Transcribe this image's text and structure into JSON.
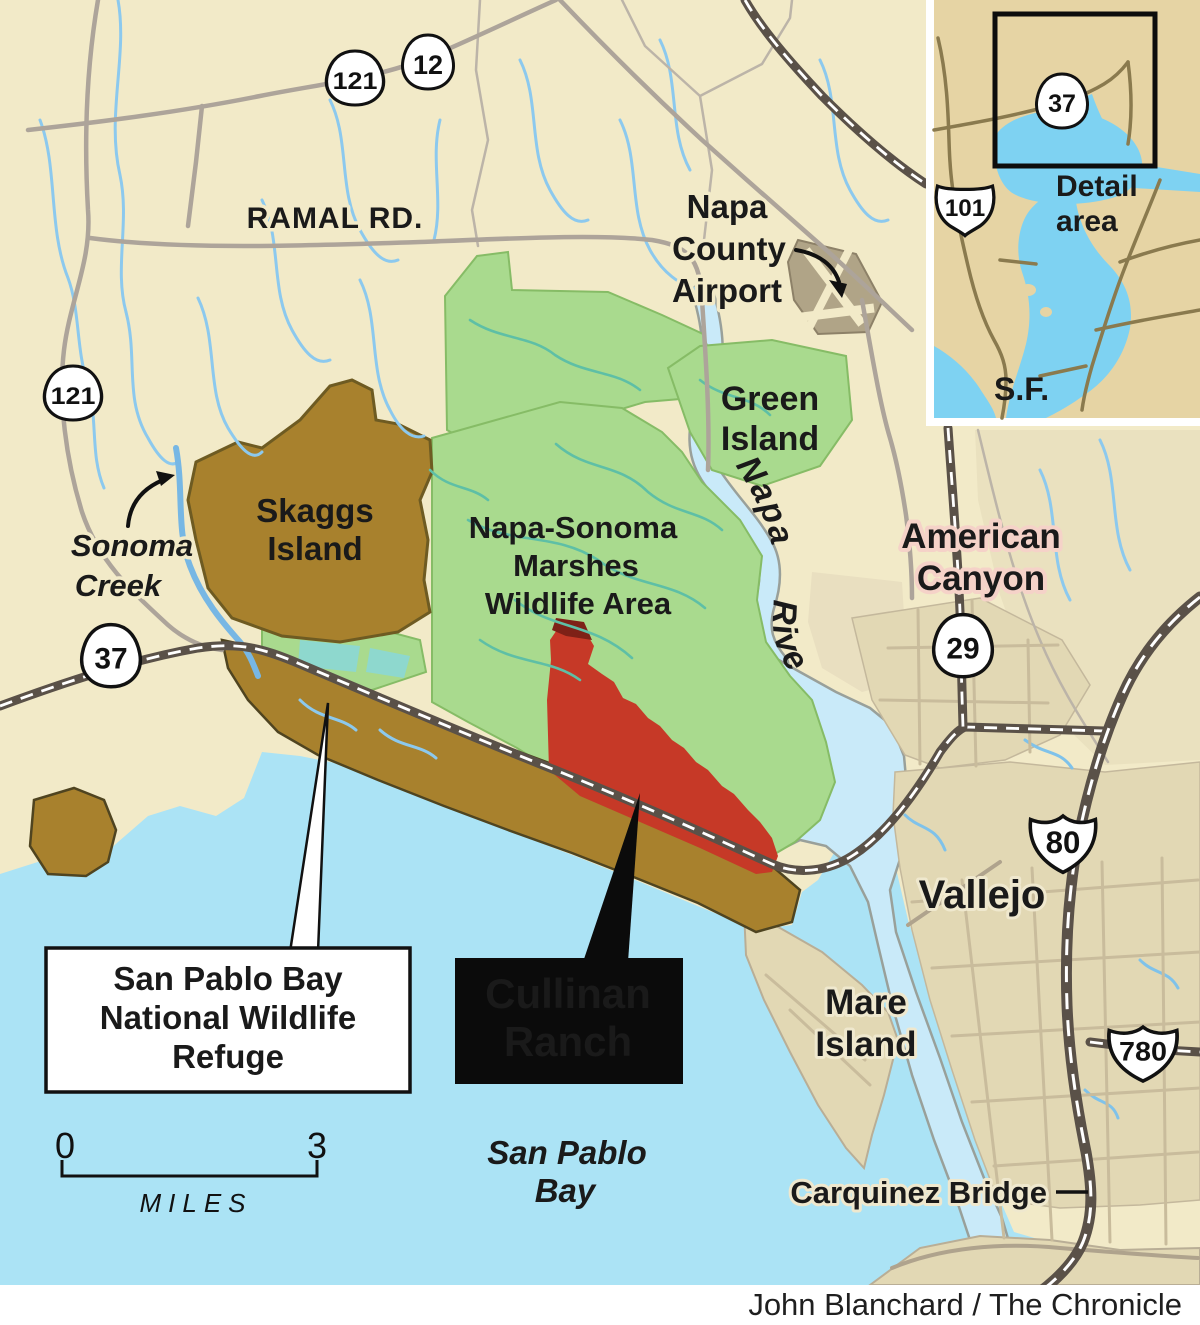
{
  "credit": "John Blanchard / The Chronicle",
  "labels": {
    "ramal_rd": "RAMAL RD.",
    "airport": [
      "Napa",
      "County",
      "Airport"
    ],
    "green_island": [
      "Green",
      "Island"
    ],
    "napa_river": "Napa River",
    "american_canyon": [
      "American",
      "Canyon"
    ],
    "sonoma_creek": [
      "Sonoma",
      "Creek"
    ],
    "skaggs_island": [
      "Skaggs",
      "Island"
    ],
    "marshes": [
      "Napa-Sonoma",
      "Marshes",
      "Wildlife Area"
    ],
    "vallejo": "Vallejo",
    "mare_island": [
      "Mare",
      "Island"
    ],
    "san_pablo_bay": [
      "San Pablo",
      "Bay"
    ],
    "carquinez": "Carquinez Bridge"
  },
  "callouts": {
    "refuge": [
      "San Pablo Bay",
      "National Wildlife",
      "Refuge"
    ],
    "cullinan": [
      "Cullinan",
      "Ranch"
    ]
  },
  "shields": {
    "hwy121_top": "121",
    "hwy12": "12",
    "hwy121_left": "121",
    "hwy37": "37",
    "hwy29": "29",
    "i80": "80",
    "i780": "780",
    "us101": "101",
    "hwy37_inset": "37"
  },
  "scale": {
    "start": "0",
    "end": "3",
    "unit": "MILES"
  },
  "inset": {
    "detail_area": [
      "Detail",
      "area"
    ],
    "sf": "S.F."
  },
  "colors": {
    "land_cream": "#F2EAC8",
    "bay_blue": "#ABE3F5",
    "river_blue": "#C9EAF9",
    "wildlife_green": "#A9DA8E",
    "refuge_brown": "#A8812D",
    "cullinan_red": "#C63927",
    "urban_tan": "#E2D8B4",
    "highway_dark": "#5A5148",
    "minor_road": "#ADA49A",
    "inset_land": "#E6D4A4",
    "inset_water": "#7ED2F2",
    "footer_white": "#FFFFFF"
  }
}
